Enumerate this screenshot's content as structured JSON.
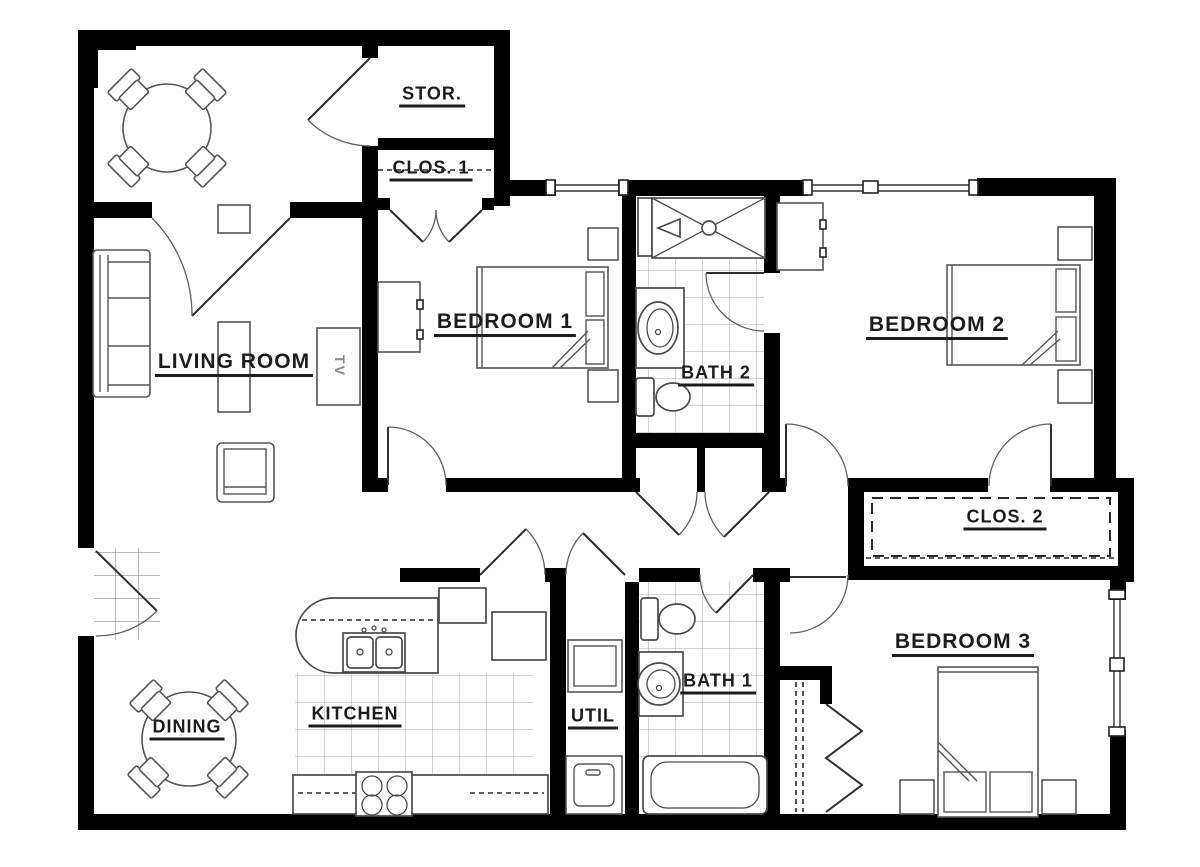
{
  "drawing": {
    "type": "apartment floor plan",
    "colors": {
      "wall": "#000000",
      "bg": "#ffffff",
      "furn": "#555555",
      "tile": "#a8a8a8",
      "label": "#1c1c1c"
    }
  },
  "rooms": {
    "storage": {
      "label": "STOR."
    },
    "closet1": {
      "label": "CLOS. 1"
    },
    "bedroom1": {
      "label": "BEDROOM 1"
    },
    "bath2": {
      "label": "BATH 2"
    },
    "bedroom2": {
      "label": "BEDROOM 2"
    },
    "living": {
      "label": "LIVING ROOM"
    },
    "closet2": {
      "label": "CLOS. 2"
    },
    "dining": {
      "label": "DINING"
    },
    "kitchen": {
      "label": "KITCHEN"
    },
    "utility": {
      "label": "UTIL"
    },
    "bath1": {
      "label": "BATH 1"
    },
    "bedroom3": {
      "label": "BEDROOM 3"
    }
  },
  "furniture": {
    "tv_label": "TV"
  }
}
